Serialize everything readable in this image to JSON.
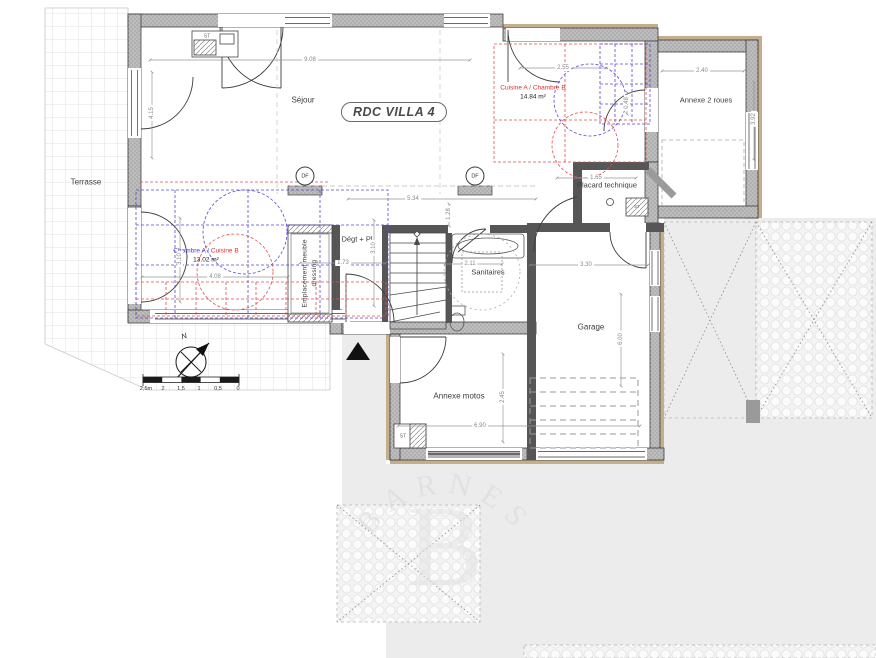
{
  "plan": {
    "title": "RDC VILLA 4",
    "rooms": {
      "sejour": {
        "label": "Séjour"
      },
      "cuisine_a": {
        "label": "Cuisine A / Chambre B",
        "area": "14.84 m²"
      },
      "annexe_2roues": {
        "label": "Annexe 2 roues"
      },
      "terrasse": {
        "label": "Terrasse"
      },
      "placard": {
        "label": "Placard technique"
      },
      "chambre_a": {
        "label_blue": "Chambre A / ",
        "label_red": "Cuisine B",
        "area": "13.02 m²"
      },
      "dressing": {
        "label": "Emplacement meuble dressing"
      },
      "degagement": {
        "label": "Dégt + Pl"
      },
      "sanitaires": {
        "label": "Sanitaires"
      },
      "garage": {
        "label": "Garage"
      },
      "annexe_motos": {
        "label": "Annexe motos"
      }
    },
    "markers": {
      "df": "DF",
      "st": "ST",
      "north": "N"
    },
    "dimensions": {
      "sejour_w": "9.08",
      "sejour_h": "4.15",
      "cuisine_w": "2.55",
      "annexe2_w": "2.40",
      "annexe2_h": "3.92",
      "cuisine_door": "0.48",
      "hall_w": "5.34",
      "hall_h": "1.28",
      "placard_w": "1.65",
      "chambre_h": "3.10",
      "chambre_w": "4.08",
      "degt_h": "3.10",
      "degt_w": "1.73",
      "sanitaires_w": "2.11",
      "garage_w": "3.30",
      "garage_h": "6.00",
      "motos_w": "6.90",
      "motos_h": "2.45"
    },
    "scale_bar": {
      "labels": [
        "2,5m",
        "2",
        "1,5",
        "1",
        "0,5",
        "0"
      ]
    },
    "watermark": {
      "brand": "BARNES",
      "monogram": "B"
    },
    "colors": {
      "overlay_red": "#e05050",
      "overlay_blue": "#5b49d6",
      "wall_gray": "#b9b9b9",
      "insulation_tan": "#c4ae8c"
    }
  }
}
